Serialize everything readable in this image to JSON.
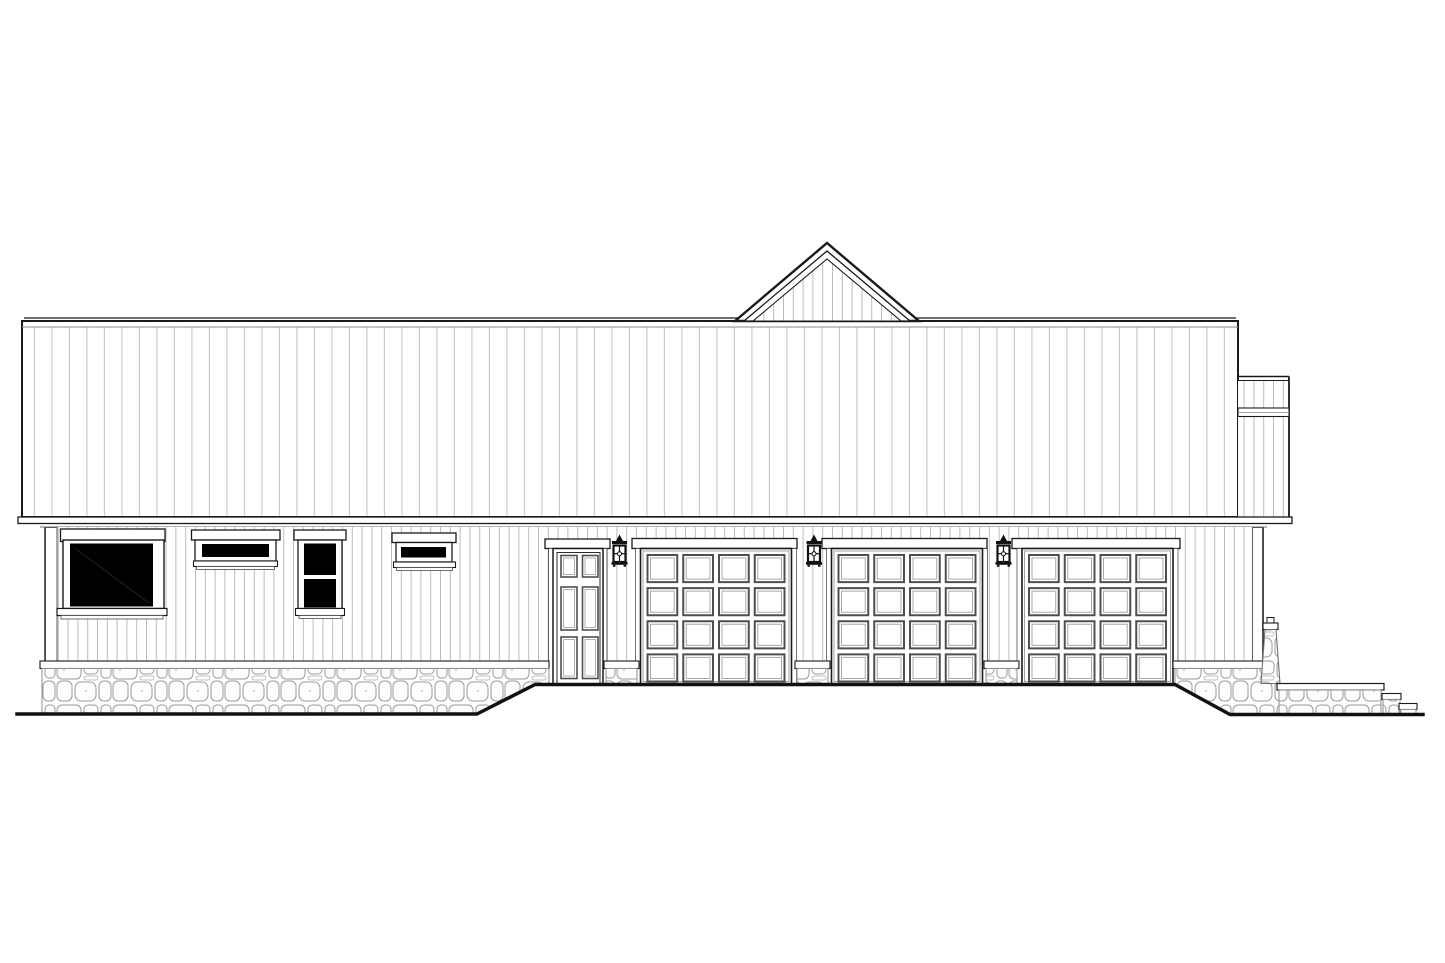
{
  "meta": {
    "drawing_type": "architectural side elevation",
    "subject": "single-story farmhouse with attached 3-car garage, stone foundation and stone stair wall",
    "paper_color": "#ffffff"
  },
  "colors": {
    "outline": "#1a1a1a",
    "panel_gray": "#4f4f4f",
    "panel_inner_gray": "#a8a8a8",
    "siding_line": "#bcbcbc",
    "roof_seam": "#c6c6c6",
    "stone_line": "#9a9a9a",
    "glass": "#000000",
    "ground": "#111111"
  },
  "roof": {
    "style": "standing-seam panels, eave-side view",
    "seam_spacing_px": 17.5,
    "gable": {
      "position": "center",
      "apex_x": 827,
      "apex_y": 243,
      "base_y": 321,
      "nested_outlines": 3
    }
  },
  "windows": [
    {
      "id": "picture-window",
      "glass_panes": 1
    },
    {
      "id": "transom-window",
      "glass_panes": 1
    },
    {
      "id": "double-hung-window",
      "glass_panes": 2
    },
    {
      "id": "small-transom-window",
      "glass_panes": 1
    }
  ],
  "entry_door": {
    "panels": 6,
    "panel_layout": "2x3",
    "panel_cols": [
      {
        "x": 561,
        "w": 16
      },
      {
        "x": 582.5,
        "w": 15.5
      }
    ],
    "panel_rows": [
      {
        "y": 555.5,
        "h": 21.5
      },
      {
        "y": 587,
        "h": 43
      },
      {
        "y": 637,
        "h": 41.5
      }
    ]
  },
  "garage": {
    "door_count": 3,
    "panel_grid": "4x4",
    "panels_per_door": 16,
    "door_y": 548.5,
    "door_w": 151,
    "door_h": 135.5,
    "doors": [
      {
        "x": 640.5
      },
      {
        "x": 831.5
      },
      {
        "x": 1022
      }
    ],
    "headers": [
      {
        "x": 632,
        "w": 165
      },
      {
        "x": 822,
        "w": 165
      },
      {
        "x": 1012,
        "w": 168
      }
    ],
    "header_y": 538.5,
    "header_h": 10,
    "pad_x": 7,
    "pad_top": 6.5,
    "pad_bottom": 2.5,
    "gap": 6
  },
  "lanterns": {
    "count": 3,
    "positions_x": [
      608.5,
      803,
      992.5
    ],
    "top_y": 534.5
  },
  "stone": {
    "foundation": "random ashlar stone veneer base along wall",
    "garden_wall": "stone knee wall with cap and two descending steps at right",
    "pillar": "battered stone pillar with cap at right building corner"
  },
  "ground": {
    "path": "M17 714 H477 L535 684.5 H1175 L1230 714.5 H1423"
  }
}
